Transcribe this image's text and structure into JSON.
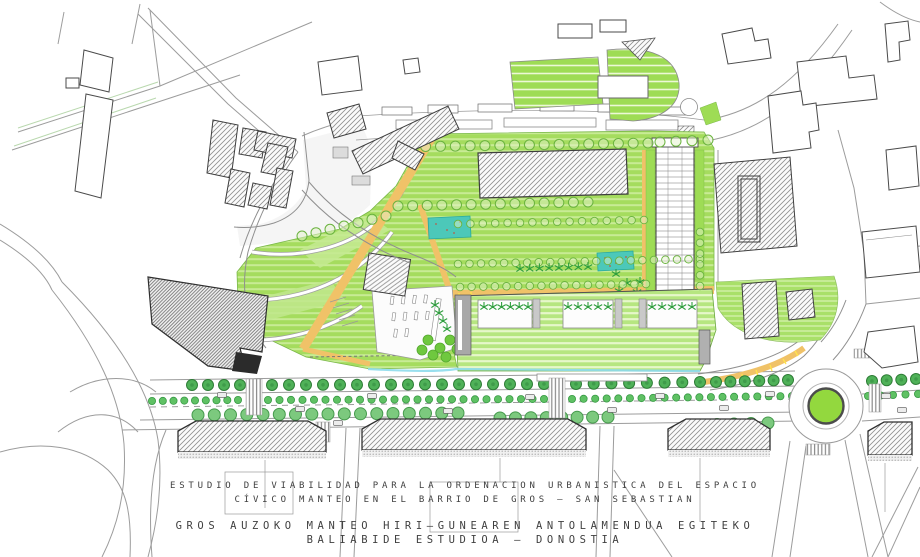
{
  "title_block": {
    "spanish": {
      "line1": "ESTUDIO DE VIABILIDAD PARA LA ORDENACION URBANISTICA DEL ESPACIO",
      "line2": "CÍVICO MANTEO EN EL BARRIO DE GROS — SAN SEBASTIAN"
    },
    "basque": {
      "line1": "GROS AUZOKO MANTEO HIRI—GUNEAREN ANTOLAMENDUA EGITEKO",
      "line2": "BALIABIDE ESTUDIOA — DONOSTIA"
    }
  },
  "map": {
    "legend": {
      "park_green": "#a5dc5e",
      "terrace_highlight_green": "#c4ea92",
      "sports_field_green": "#9edc55",
      "roof_garden_green": "#b6e680",
      "east_slope_green": "#a9e069",
      "path_orange": "#f0c268",
      "path_mark_yellow": "#ffe34d",
      "pond_teal": "#4cc8b9",
      "roundabout_green": "#93d83e",
      "water_edge_cyan": "#8edcec",
      "street_tree_dark_green": "#4fb158",
      "street_tree_light_green": "#5fc164",
      "park_tree_outline_green": "#6ab33e",
      "palm_green": "#2f9e3e",
      "building_hatch_gray": "#8f8f8f",
      "building_outline_gray": "#3e3e3e",
      "road_line_gray": "#9c9c9c"
    }
  }
}
